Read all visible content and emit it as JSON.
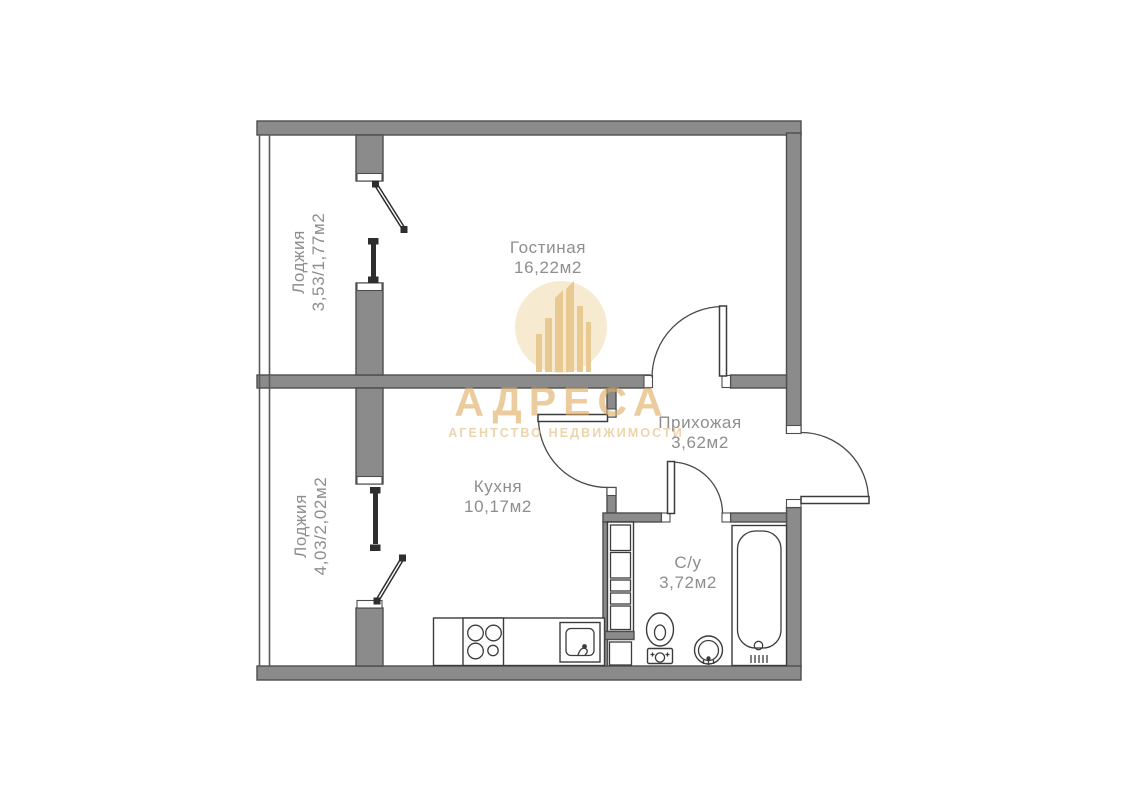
{
  "watermark": {
    "brand": "АДРЕСА",
    "tagline": "АГЕНТСТВО НЕДВИЖИМОСТИ"
  },
  "rooms": {
    "living": {
      "name": "Гостиная",
      "area": "16,22м2"
    },
    "kitchen": {
      "name": "Кухня",
      "area": "10,17м2"
    },
    "hallway": {
      "name": "Прихожая",
      "area": "3,62м2"
    },
    "bathroom": {
      "name": "С/у",
      "area": "3,72м2"
    },
    "loggia_top": {
      "name": "Лоджия",
      "area": "3,53/1,77м2"
    },
    "loggia_bottom": {
      "name": "Лоджия",
      "area": "4,03/2,02м2"
    }
  },
  "colors": {
    "wall_fill": "#8b8b8b",
    "wall_outline": "#4e4e4e",
    "fixture_line": "#3c3c3c",
    "window_glass": "#2e2e2e",
    "label_text": "#8e8e8e",
    "watermark_gold": "#dfae63",
    "watermark_tagline": "#e2bb79",
    "watermark_blob": "#f2dfb6",
    "watermark_bars": "#d9a94f"
  }
}
